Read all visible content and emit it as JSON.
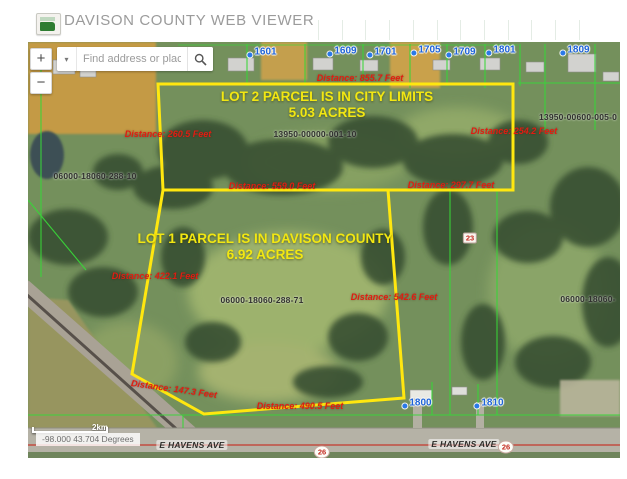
{
  "header": {
    "title": "DAVISON COUNTY WEB VIEWER"
  },
  "controls": {
    "zoom_in": "+",
    "zoom_out": "−",
    "dropdown_icon": "▾",
    "search_placeholder": "Find address or place"
  },
  "map": {
    "lot_labels": [
      {
        "name": "lot-2-label",
        "line1": "LOT 2 PARCEL IS IN CITY LIMITS",
        "line2": "5.03 ACRES",
        "x": 299,
        "y": 63
      },
      {
        "name": "lot-1-label",
        "line1": "LOT 1 PARCEL IS IN DAVISON COUNTY",
        "line2": "6.92 ACRES",
        "x": 237,
        "y": 205
      }
    ],
    "parcel_numbers": [
      {
        "text": "1601",
        "x": 234,
        "y": 10
      },
      {
        "text": "1609",
        "x": 314,
        "y": 9
      },
      {
        "text": "1701",
        "x": 354,
        "y": 10
      },
      {
        "text": "1705",
        "x": 398,
        "y": 8
      },
      {
        "text": "1709",
        "x": 433,
        "y": 10
      },
      {
        "text": "1801",
        "x": 473,
        "y": 8
      },
      {
        "text": "1809",
        "x": 547,
        "y": 8
      },
      {
        "text": "1800",
        "x": 389,
        "y": 361
      },
      {
        "text": "1810",
        "x": 461,
        "y": 361
      }
    ],
    "parcel_ids": [
      {
        "text": "13950-00000-001-10",
        "x": 287,
        "y": 92
      },
      {
        "text": "13950-00600-005-0",
        "x": 550,
        "y": 75
      },
      {
        "text": "06000-18060-288-10",
        "x": 67,
        "y": 134
      },
      {
        "text": "06000-18060-288-71",
        "x": 234,
        "y": 258
      },
      {
        "text": "06000-18060-",
        "x": 560,
        "y": 257
      }
    ],
    "distance_labels": [
      {
        "text": "Distance: 855.7 Feet",
        "x": 332,
        "y": 36,
        "rot": 0
      },
      {
        "text": "Distance: 260.5 Feet",
        "x": 140,
        "y": 92,
        "rot": 0
      },
      {
        "text": "Distance: 254.2 Feet",
        "x": 486,
        "y": 89,
        "rot": 0
      },
      {
        "text": "Distance: 559.0 Feet",
        "x": 244,
        "y": 144,
        "rot": 0
      },
      {
        "text": "Distance: 297.7 Feet",
        "x": 423,
        "y": 143,
        "rot": 0
      },
      {
        "text": "Distance: 422.1 Feet",
        "x": 127,
        "y": 234,
        "rot": 0
      },
      {
        "text": "Distance: 542.6 Feet",
        "x": 366,
        "y": 255,
        "rot": 0
      },
      {
        "text": "Distance: 147.3 Feet",
        "x": 146,
        "y": 347,
        "rot": 8
      },
      {
        "text": "Distance: 490.5 Feet",
        "x": 272,
        "y": 364,
        "rot": 0
      }
    ],
    "road_labels": [
      {
        "text": "E HAVENS AVE",
        "x": 164,
        "y": 403
      },
      {
        "text": "E HAVENS AVE",
        "x": 436,
        "y": 402
      }
    ],
    "highway_markers": [
      {
        "text": "26",
        "x": 294,
        "y": 410
      },
      {
        "text": "26",
        "x": 478,
        "y": 405
      }
    ],
    "corner_marker": "23",
    "scale_label": "2km",
    "coordinates": "-98.000 43.704 Degrees"
  },
  "colors": {
    "lot_outline": "#ffe70f",
    "distance_text": "#e01d12",
    "parcel_number_text": "#1e63d8",
    "parcel_line_green": "#39d639",
    "lot_label_yellow": "#f2e712"
  }
}
